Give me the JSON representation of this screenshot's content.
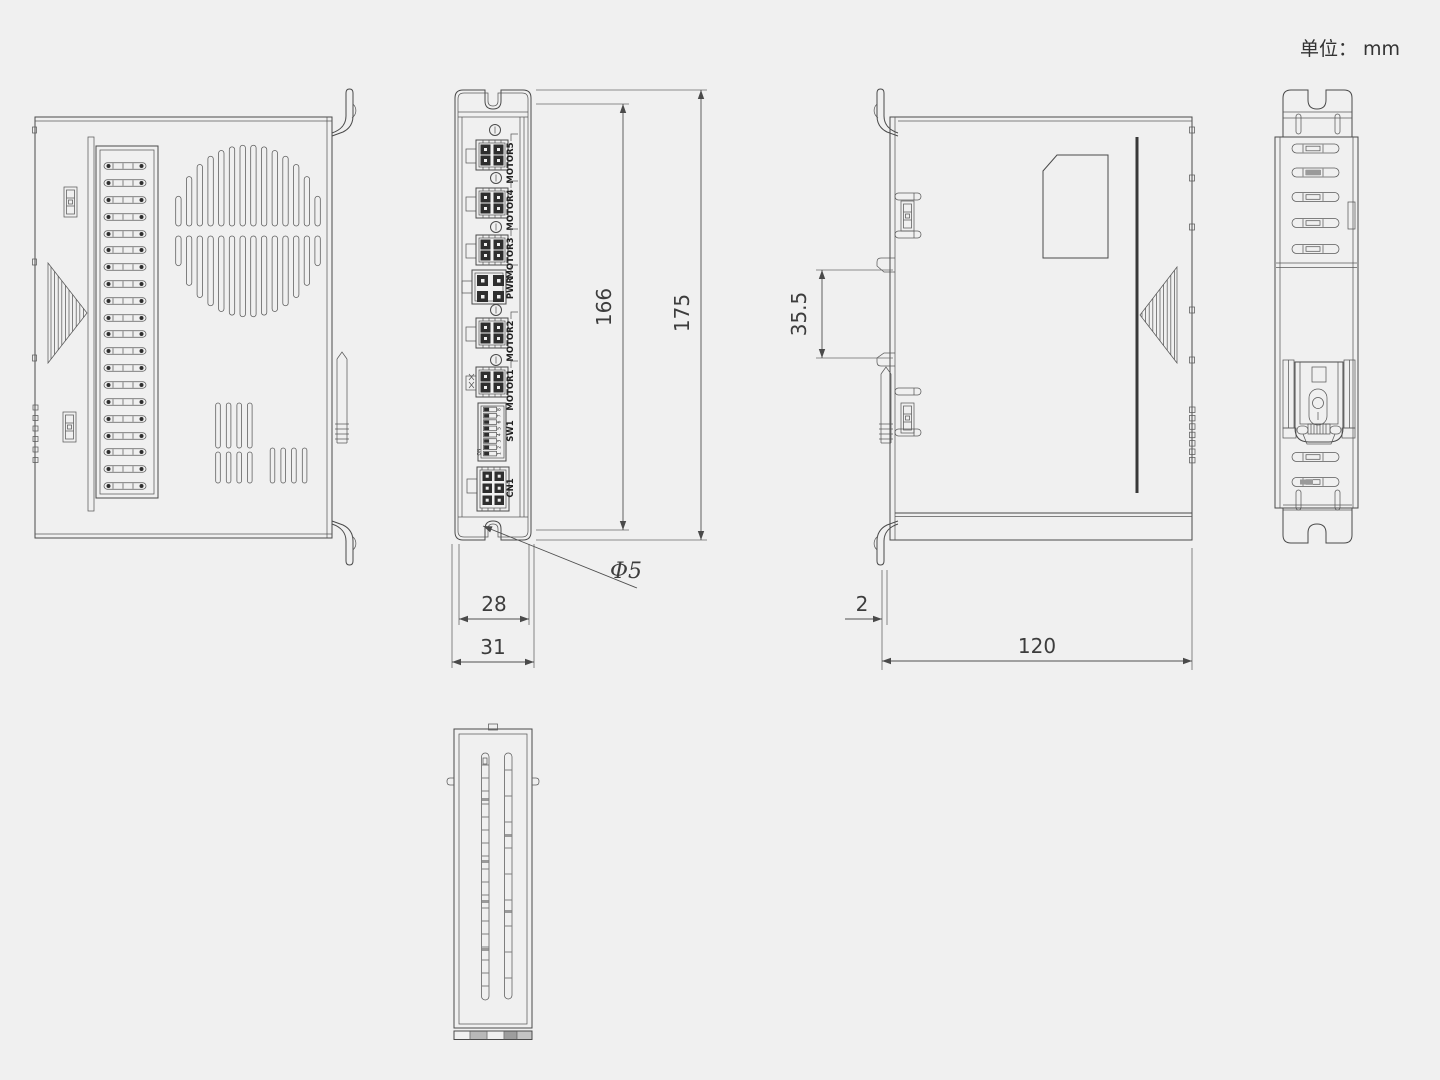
{
  "unit_note": "单位： mm",
  "front_panel": {
    "connector_labels": {
      "motor5": "MOTOR5",
      "motor4": "MOTOR4",
      "motor3": "MOTOR3",
      "pwr": "PWR",
      "motor2": "MOTOR2",
      "motor1": "MOTOR1",
      "sw1": "SW1",
      "cn1": "CN1"
    },
    "dip": {
      "on_label": "ON",
      "numbers": [
        "1",
        "2",
        "3",
        "4",
        "5",
        "6",
        "7",
        "8"
      ]
    }
  },
  "dimensions": {
    "mount_hole_pitch": "166",
    "overall_height": "175",
    "front_width": "28",
    "overall_width": "31",
    "mount_hole_dia": "Φ5",
    "din_hook_pitch": "35.5",
    "flange_thickness": "2",
    "body_depth": "120"
  }
}
